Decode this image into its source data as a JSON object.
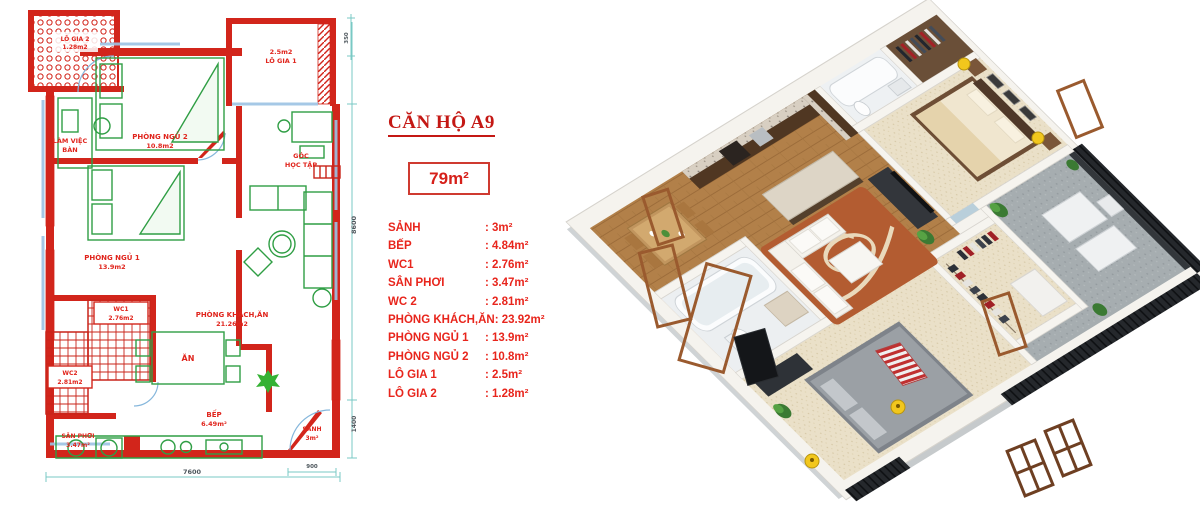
{
  "info_panel": {
    "title": "CĂN HỘ A9",
    "total_area": "79m²",
    "rooms": [
      {
        "label": "SẢNH",
        "value": ": 3m²"
      },
      {
        "label": "BẾP",
        "value": ": 4.84m²"
      },
      {
        "label": "WC1",
        "value": ": 2.76m²"
      },
      {
        "label": "SÂN PHƠI",
        "value": ": 3.47m²"
      },
      {
        "label": "WC 2",
        "value": ": 2.81m²"
      },
      {
        "label": "PHÒNG KHÁCH,ĂN",
        "value": ": 23.92m²"
      },
      {
        "label": "PHÒNG NGỦ 1",
        "value": ": 13.9m²"
      },
      {
        "label": "PHÒNG NGỦ 2",
        "value": ": 10.8m²"
      },
      {
        "label": "LÔ GIA 1",
        "value": ": 2.5m²"
      },
      {
        "label": "LÔ GIA 2",
        "value": ": 1.28m²"
      }
    ]
  },
  "floor_plan": {
    "rooms": {
      "logia2_name": "LÔ GIA 2",
      "logia2_area": "1.28m2",
      "lamviec_line1": "LÀM VIỆC",
      "lamviec_line2": "BÀN",
      "bedroom2_name": "PHÒNG NGỦ 2",
      "bedroom2_area": "10.8m2",
      "logia1_area": "2.5m2",
      "logia1_name": "LÔ GIA 1",
      "study_line1": "GÓC",
      "study_line2": "HỌC TẬP",
      "bedroom1_name": "PHÒNG NGỦ 1",
      "bedroom1_area": "13.9m2",
      "wc1_name": "WC1",
      "wc1_area": "2.76m2",
      "wc2_name": "WC2",
      "wc2_area": "2.81m2",
      "sanphoi_name": "SÂN PHƠI",
      "sanphoi_area": "3.47m²",
      "dining_name": "ĂN",
      "living_name": "PHÒNG KHÁCH,ĂN",
      "living_area": "21.26m2",
      "kitchen_name": "BẾP",
      "kitchen_area": "6.49m²",
      "hall_name": "SẢNH",
      "hall_area": "3m²"
    },
    "dimensions": {
      "bottom": "7600",
      "right_main": "8600",
      "right_lower": "1400",
      "hall": "900",
      "top_right": "350"
    }
  },
  "colors": {
    "wall_red": "#d2251b",
    "furniture_green": "#2f9e44",
    "label_red": "#e0241c",
    "dimension_teal": "#79c9c4",
    "wood_floor": "#b28049",
    "carpet_cream": "#eae0c8",
    "balcony_gray": "#a6adb0",
    "stool_red": "#c32724"
  }
}
